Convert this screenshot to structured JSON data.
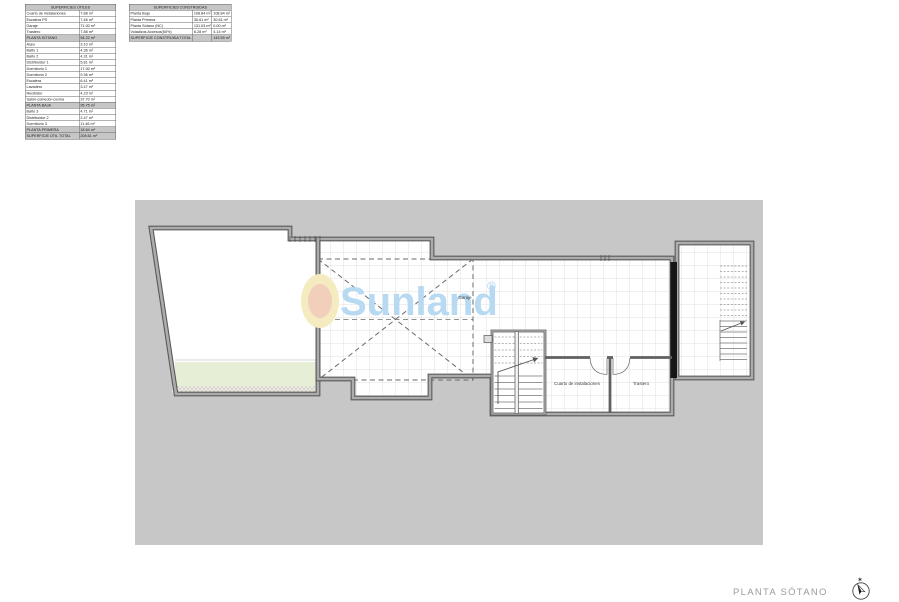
{
  "tables": {
    "utiles": {
      "title": "SUPERFICIES ÚTILES",
      "rows": [
        {
          "label": "Cuarto de instalaciones",
          "value": "7.88 m²"
        },
        {
          "label": "Escalera PS",
          "value": "7.46 m²"
        },
        {
          "label": "Garaje",
          "value": "71.00 m²"
        },
        {
          "label": "Trastero",
          "value": "7.88 m²"
        },
        {
          "label": "PLANTA SÓTANO",
          "value": "94.22 m²",
          "highlight": true
        },
        {
          "label": "Aseo",
          "value": "3.10 m²"
        },
        {
          "label": "Baño 1",
          "value": "4.36 m²"
        },
        {
          "label": "Baño 2",
          "value": "4.31 m²"
        },
        {
          "label": "Distribuidor 1",
          "value": "5.81 m²"
        },
        {
          "label": "Dormitorio 1",
          "value": "17.00 m²"
        },
        {
          "label": "Dormitorio 2",
          "value": "9.36 m²"
        },
        {
          "label": "Escalera",
          "value": "6.41 m²"
        },
        {
          "label": "Lavadero",
          "value": "3.47 m²"
        },
        {
          "label": "Recibidor",
          "value": "4.23 m²"
        },
        {
          "label": "Salón-comedor-cocina",
          "value": "37.70 m²"
        },
        {
          "label": "PLANTA BAJA",
          "value": "95.75 m²",
          "highlight": true
        },
        {
          "label": "Baño 3",
          "value": "4.71 m²"
        },
        {
          "label": "Distribuidor 2",
          "value": "2.47 m²"
        },
        {
          "label": "Dormitorio 3",
          "value": "11.46 m²"
        },
        {
          "label": "PLANTA PRIMERA",
          "value": "18.64 m²",
          "highlight": true
        },
        {
          "label": "SUPERFICIE ÚTIL TOTAL",
          "value": "208.61 m²",
          "highlight": true
        }
      ]
    },
    "construidas": {
      "title": "SUPERFICIES CONSTRUIDAS",
      "rows": [
        {
          "label": "Planta Baja",
          "v1": "108.84 m²",
          "v2": "108.84 m²"
        },
        {
          "label": "Planta Primera",
          "v1": "30.61 m²",
          "v2": "30.61 m²"
        },
        {
          "label": "Planta Sótano (NC)",
          "v1": "131.03 m²",
          "v2": "0.00 m²"
        },
        {
          "label": "Voladizos Accesos(50%)",
          "v1": "8.28 m²",
          "v2": "4.14 m²"
        },
        {
          "label": "SUPERFICIE CONSTRUIDA TOTAL",
          "v1": "",
          "v2": "143.59 m²",
          "highlight": true
        }
      ]
    }
  },
  "plan": {
    "labels": {
      "garage": "Garaje",
      "utility": "Cuarto de instalaciones",
      "storage": "Trastero"
    },
    "watermark": {
      "text": "Sunland",
      "reg": "®"
    }
  },
  "footer": {
    "caption": "PLANTA SÓTANO"
  },
  "colors": {
    "canvas_gray": "#c7c7c7",
    "garden_green": "#e6eed6",
    "watermark_blue": "#b7d9f1",
    "logo_yellow": "#f5ebc1",
    "logo_orange": "#f2cfba"
  }
}
